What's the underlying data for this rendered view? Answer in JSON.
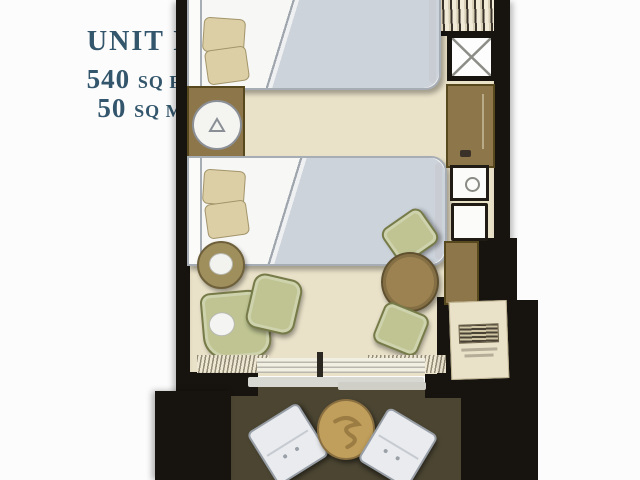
{
  "unit_label": {
    "title": "UNIT E",
    "area_ft_value": "540",
    "area_ft_unit": "SQ FT",
    "area_m_value": "50",
    "area_m_unit": "SQ M"
  },
  "colors": {
    "label_ink": "#33566c",
    "wall": "#17140f",
    "room_floor": "#e9e1c8",
    "balcony_floor": "#4b4532",
    "wood_cabinet": "#8d774a",
    "wood_edge": "#57481e",
    "dining_table_wood": "#9c8251",
    "upholstery_green": "#bfc492",
    "upholstery_green_edge": "#767b49",
    "duvet_gray": "#cdd3db",
    "bed_white": "#f7f7f5",
    "pillow_tan": "#dccfa6",
    "white_furniture": "#e9ebee",
    "white_furniture_edge": "#989ea6",
    "balcony_table_tan": "#c09e5b",
    "threshold_gray": "#d8d8d2"
  },
  "furniture_icons": [
    "bed",
    "bed",
    "nightstand",
    "table-lamp",
    "round-side-table",
    "armchair",
    "ottoman",
    "round-dining-table",
    "dining-chair",
    "dining-chair",
    "wardrobe-with-hangers",
    "shower-enclosure",
    "bathroom-vanity",
    "sink",
    "toilet",
    "linen-closet",
    "ac-unit",
    "curtains",
    "sliding-glass-door",
    "entry-door-swing",
    "balcony-chair",
    "balcony-chair",
    "balcony-round-table"
  ]
}
